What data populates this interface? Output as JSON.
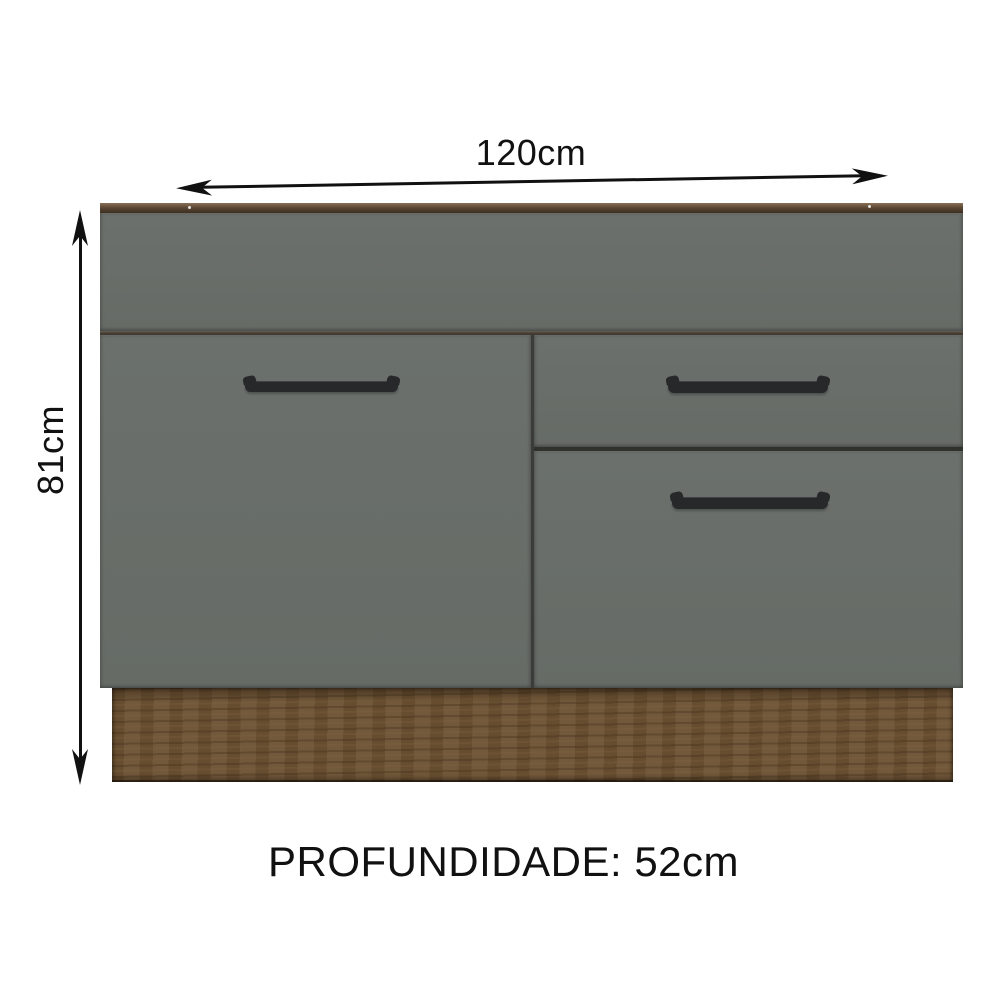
{
  "labels": {
    "width": "120cm",
    "height": "81cm",
    "depth": "PROFUNDIDADE: 52cm"
  },
  "cabinet": {
    "type": "kitchen-sink-base-cabinet-front-view",
    "parts": [
      "wood-top-edge",
      "top-rail-panel",
      "left-door",
      "top-drawer",
      "bottom-drawer",
      "wood-plinth"
    ],
    "handle_count": 3
  },
  "colors": {
    "background": "#ffffff",
    "annotation": "#111111",
    "front": "#6b706c",
    "front_dark": "#666b66",
    "wood_edge_light": "#8a7258",
    "wood_edge_mid": "#5d4936",
    "wood_edge_dark": "#3c2e1f",
    "plinth": "#6d5233",
    "handle": "#26282a"
  }
}
